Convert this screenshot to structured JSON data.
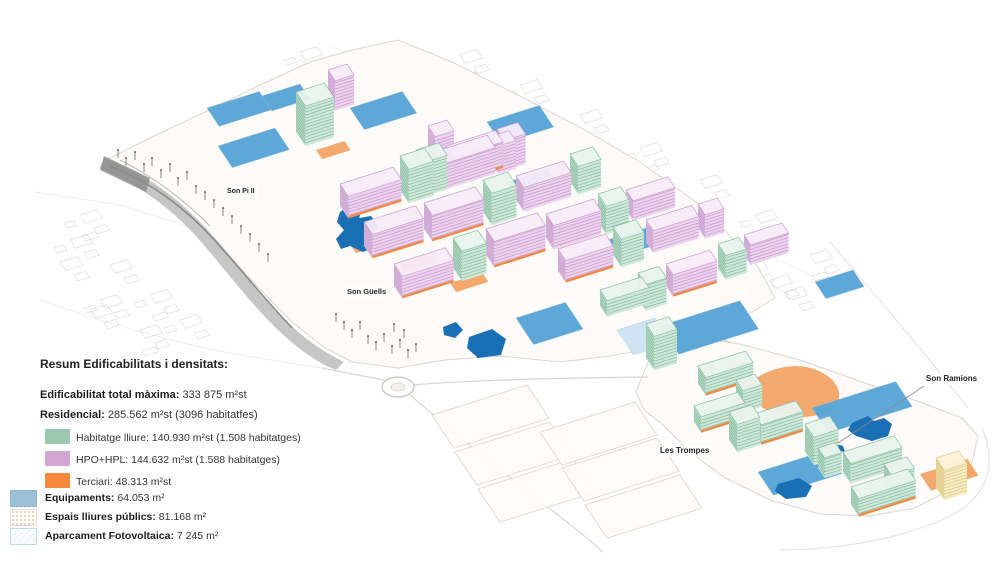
{
  "map": {
    "labels": [
      {
        "id": "son-pi-ii",
        "text": "Son Pi II"
      },
      {
        "id": "son-guells",
        "text": "Son Güells"
      },
      {
        "id": "les-trompes",
        "text": "Les Trompes"
      },
      {
        "id": "son-ramions",
        "text": "Son Ramions"
      }
    ]
  },
  "legend": {
    "title": "Resum Edificabilitats i densitats:",
    "summary": [
      {
        "label": "Edificabilitat total màxima:",
        "value": "333 875 m²st"
      },
      {
        "label": "Residencial:",
        "value": "285.562 m²st (3096 habitatfes)"
      }
    ],
    "residential_items": [
      {
        "label": "Habitatge lliure:",
        "value": "140.930 m²st (1.508 habitatges)",
        "swatch": "#9ac7ad"
      },
      {
        "label": "HPO+HPL:",
        "value": "144.632 m²st (1.588 habitatges)",
        "swatch": "#d2a5d4"
      },
      {
        "label": "Terciari:",
        "value": "48.313 m²st",
        "swatch": "#f6893b"
      }
    ],
    "other_items": [
      {
        "label": "Equipaments:",
        "value": "64.053 m²",
        "swatch": "#9cbfd6"
      },
      {
        "label": "Espais lliures públics:",
        "value": "81.168 m²"
      },
      {
        "label": "Aparcament Fotovoltaica:",
        "value": "7 245 m²"
      }
    ]
  },
  "palette": {
    "residential_free_green": "#9ac7ad",
    "hpo_hpl_pink": "#d2a5d4",
    "terciari_orange": "#f6893b",
    "equipaments_legend_blue": "#9cbfd6",
    "parcel_blue": "#58a6d8",
    "parcel_blue_light": "#cfe4f2",
    "pond_blue": "#1a6fb5",
    "orange_patch": "#f3a96e",
    "orange_strip": "#ef8a45",
    "yellow_building": "#f6ecc3",
    "terrain_gray": "#aeaeae",
    "linework_gray": "#b8b4ae"
  }
}
